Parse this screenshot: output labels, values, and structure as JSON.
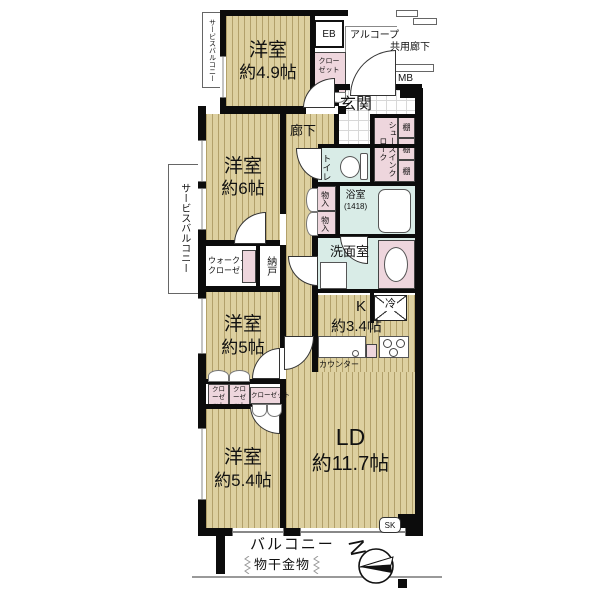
{
  "floorplan": {
    "rooms": {
      "service_balcony": "サービスバルコニー",
      "yoshitsu_49": {
        "name": "洋室",
        "size": "約4.9帖"
      },
      "yoshitsu_6": {
        "name": "洋室",
        "size": "約6帖"
      },
      "yoshitsu_5": {
        "name": "洋室",
        "size": "約5帖"
      },
      "yoshitsu_54": {
        "name": "洋室",
        "size": "約5.4帖"
      },
      "ld": {
        "name": "LD",
        "size": "約11.7帖"
      },
      "kitchen": {
        "name": "K",
        "size": "約3.4帖"
      },
      "genkan": "玄関",
      "corridor": "廊下",
      "toilet": "トイレ",
      "bath": {
        "name": "浴室",
        "size": "(1418)"
      },
      "washroom": "洗面室",
      "walk_in_closet": {
        "line1": "ウォークイン",
        "line2": "クローゼット"
      },
      "nando": "納戸",
      "shoes_in_cloak": "シューズインクローク",
      "balcony": "バルコニー",
      "common_corridor": "共用廊下",
      "alcove": "アルコープ"
    },
    "labels": {
      "eb": "EB",
      "mb": "MB",
      "sk": "SK",
      "fridge": "冷",
      "counter": "カウンター",
      "shelf": "棚",
      "closet": "クローゼット",
      "storage": "物入",
      "drying_fixture": "物干金物",
      "north": "N"
    },
    "colors": {
      "floor": "#ddd0a0",
      "stripe": "#b2a06a",
      "wet_area": "#d9ece7",
      "closet_pink": "#eed6dd",
      "wall": "#0c0c0c"
    }
  }
}
